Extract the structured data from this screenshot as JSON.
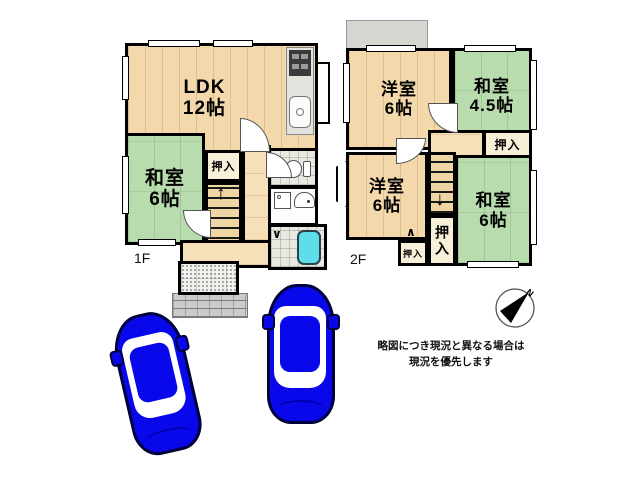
{
  "floor1": {
    "label": "1F",
    "ldk": {
      "name": "LDK",
      "size": "12帖"
    },
    "washitsu": {
      "name": "和室",
      "size": "6帖"
    },
    "oshiire_label": "押入"
  },
  "floor2": {
    "label": "2F",
    "yoshitsu_top": {
      "name": "洋室",
      "size": "6帖"
    },
    "washitsu_45": {
      "name": "和室",
      "size": "4.5帖"
    },
    "yoshitsu_bottom": {
      "name": "洋室",
      "size": "6帖"
    },
    "washitsu_6": {
      "name": "和室",
      "size": "6帖"
    },
    "oshiire_top_label": "押入",
    "oshiire_side_label": "押入",
    "oshiire_small_label": "押入"
  },
  "icons": {
    "stairs_up_arrow": "↑",
    "stairs_down_arrow": "↓",
    "door_fold_down": "∨",
    "door_fold_up": "∧",
    "compass_north": "N"
  },
  "disclaimer": {
    "line1": "略図につき現況と異なる場合は",
    "line2": "現況を優先します"
  },
  "colors": {
    "wood_floor": "#f2d8aa",
    "tatami": "#b9dcae",
    "wall": "#000000",
    "bathtub": "#5fdde8",
    "car_blue": "#0808ea",
    "balcony_gray": "#d6d6d0",
    "porch_gray": "#cccccc"
  }
}
